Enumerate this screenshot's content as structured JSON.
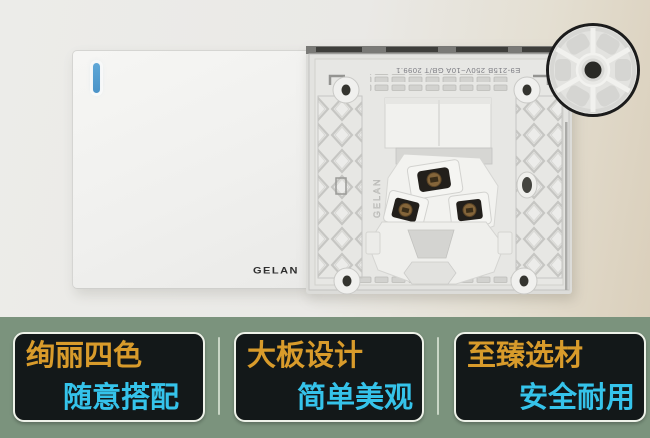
{
  "product": {
    "front_panel": {
      "brand": "GELAN"
    },
    "back_panel": {
      "marking": "E9-215B 250V~10A GB/T 2099.1",
      "embossed_brand": "GELAN"
    }
  },
  "features": {
    "items": [
      {
        "title": "绚丽四色",
        "subtitle": "随意搭配"
      },
      {
        "title": "大板设计",
        "subtitle": "简单美观"
      },
      {
        "title": "至臻选材",
        "subtitle": "安全耐用"
      }
    ]
  },
  "colors": {
    "indicator-blue": "#4a93c8",
    "feature-bg": "#7b937d",
    "feature-card-bg": "#131819",
    "feature-title": "#d89b2b",
    "feature-subtitle": "#35c3ea",
    "card-border": "#eef2e9"
  }
}
